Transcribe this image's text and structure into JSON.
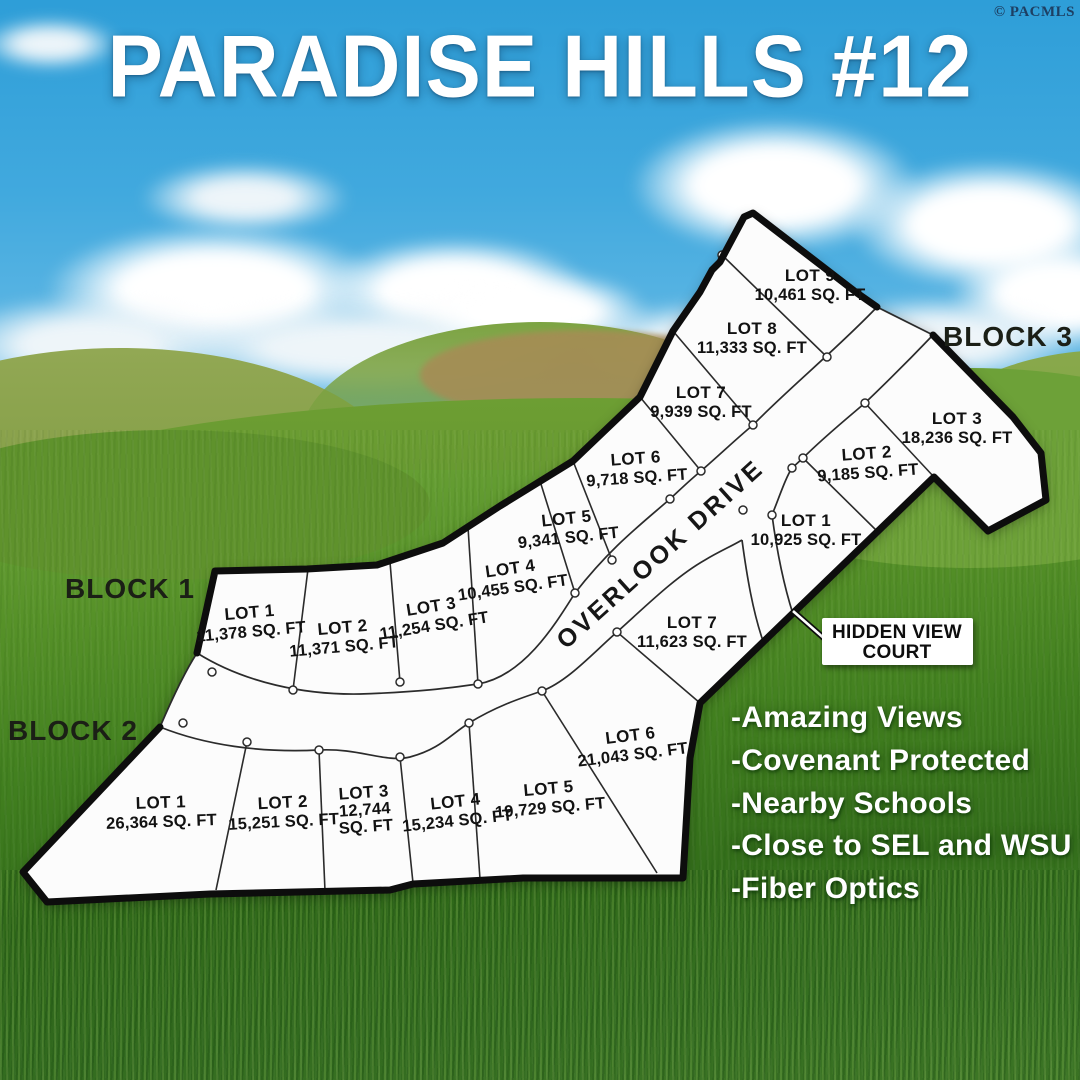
{
  "watermark": "© PACMLS",
  "title": "PARADISE HILLS #12",
  "map": {
    "streets": {
      "overlook": "OVERLOOK DRIVE",
      "hidden_view_line1": "HIDDEN VIEW",
      "hidden_view_line2": "COURT"
    },
    "blocks": [
      {
        "label": "BLOCK 1",
        "lots": [
          {
            "name": "LOT 1",
            "area": "11,378 SQ. FT"
          },
          {
            "name": "LOT 2",
            "area": "11,371 SQ. FT"
          },
          {
            "name": "LOT 3",
            "area": "11,254 SQ. FT"
          },
          {
            "name": "LOT 4",
            "area": "10,455 SQ. FT"
          },
          {
            "name": "LOT 5",
            "area": "9,341 SQ. FT"
          },
          {
            "name": "LOT 6",
            "area": "9,718 SQ. FT"
          },
          {
            "name": "LOT 7",
            "area": "9,939 SQ. FT"
          },
          {
            "name": "LOT 8",
            "area": "11,333 SQ. FT"
          },
          {
            "name": "LOT 9",
            "area": "10,461 SQ. FT"
          }
        ]
      },
      {
        "label": "BLOCK 2",
        "lots": [
          {
            "name": "LOT 1",
            "area": "26,364 SQ. FT"
          },
          {
            "name": "LOT 2",
            "area": "15,251 SQ. FT"
          },
          {
            "name": "LOT 3",
            "area": "12,744 SQ. FT",
            "area_line1": "12,744",
            "area_line2": "SQ. FT"
          },
          {
            "name": "LOT 4",
            "area": "15,234 SQ. FT"
          },
          {
            "name": "LOT 5",
            "area": "19,729 SQ. FT"
          },
          {
            "name": "LOT 6",
            "area": "21,043 SQ. FT"
          }
        ]
      },
      {
        "label": "BLOCK 3",
        "lots": [
          {
            "name": "LOT 1",
            "area": "10,925 SQ. FT"
          },
          {
            "name": "LOT 2",
            "area": "9,185 SQ. FT"
          },
          {
            "name": "LOT 3",
            "area": "18,236 SQ. FT"
          },
          {
            "name": "LOT 7",
            "area": "11,623 SQ. FT"
          }
        ]
      }
    ]
  },
  "features": [
    "-Amazing Views",
    "-Covenant Protected",
    "-Nearby Schools",
    "-Close to SEL and WSU",
    "-Fiber Optics"
  ],
  "colors": {
    "sky_top": "#2e9ed8",
    "grass": "#417f1f",
    "plat_fill": "#fcfcfc",
    "line": "#2b2b2b",
    "border": "#0d0d0d",
    "text_light": "#ffffff"
  }
}
